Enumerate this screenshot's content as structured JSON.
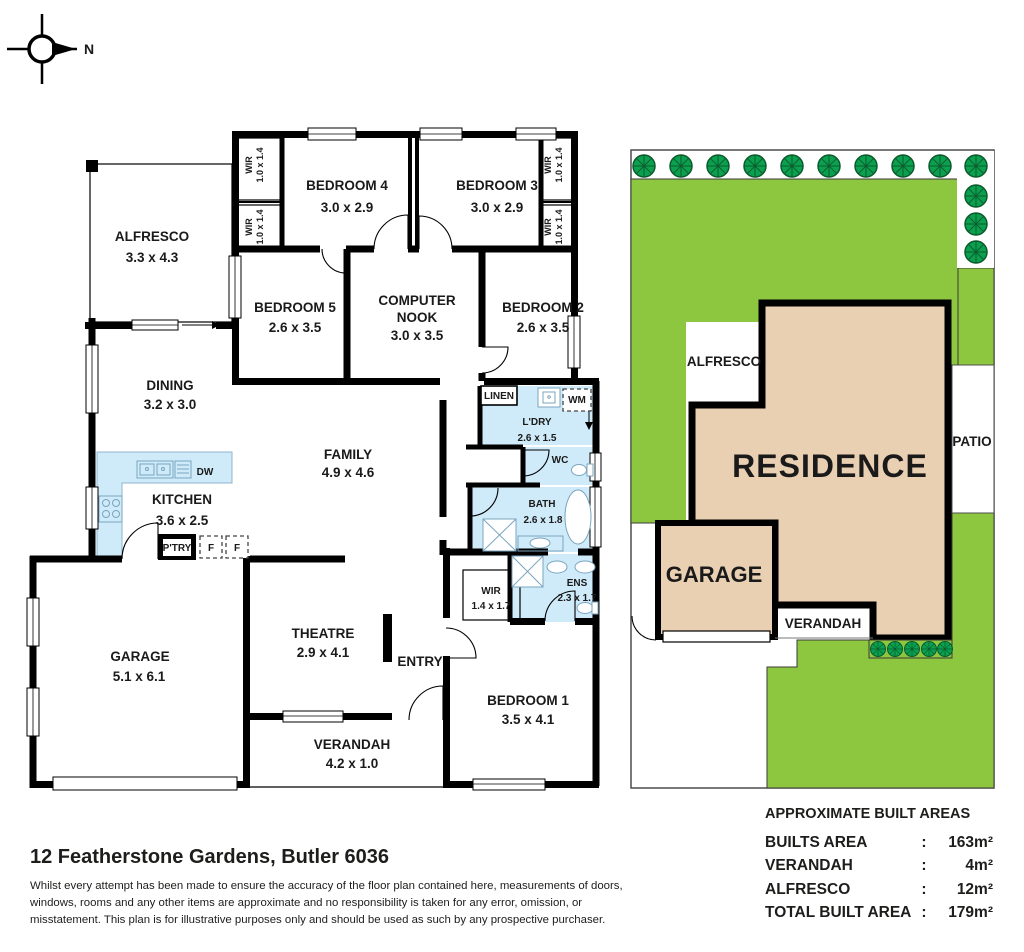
{
  "compass": {
    "north_label": "N"
  },
  "floor_plan": {
    "rooms": {
      "alfresco": {
        "name": "ALFRESCO",
        "dims": "3.3 x 4.3"
      },
      "bedroom4": {
        "name": "BEDROOM 4",
        "dims": "3.0 x 2.9"
      },
      "bedroom3": {
        "name": "BEDROOM 3",
        "dims": "3.0 x 2.9"
      },
      "bedroom5": {
        "name": "BEDROOM 5",
        "dims": "2.6 x 3.5"
      },
      "computer_nook": {
        "name_line1": "COMPUTER",
        "name_line2": "NOOK",
        "dims": "3.0 x 3.5"
      },
      "bedroom2": {
        "name": "BEDROOM 2",
        "dims": "2.6 x 3.5"
      },
      "dining": {
        "name": "DINING",
        "dims": "3.2 x 3.0"
      },
      "family": {
        "name": "FAMILY",
        "dims": "4.9 x 4.6"
      },
      "kitchen": {
        "name": "KITCHEN",
        "dims": "3.6 x 2.5"
      },
      "laundry": {
        "name": "L'DRY",
        "dims": "2.6 x 1.5"
      },
      "wc": {
        "name": "WC"
      },
      "bath": {
        "name": "BATH",
        "dims": "2.6 x 1.8"
      },
      "ens": {
        "name": "ENS",
        "dims": "2.3 x 1.7"
      },
      "wir_main": {
        "name": "WIR",
        "dims": "1.4 x 1.7"
      },
      "garage": {
        "name": "GARAGE",
        "dims": "5.1 x 6.1"
      },
      "theatre": {
        "name": "THEATRE",
        "dims": "2.9 x 4.1"
      },
      "entry": {
        "name": "ENTRY"
      },
      "verandah": {
        "name": "VERANDAH",
        "dims": "4.2 x 1.0"
      },
      "bedroom1": {
        "name": "BEDROOM 1",
        "dims": "3.5 x 4.1"
      }
    },
    "closets": {
      "wir": "WIR",
      "wir_dims": "1.0 x 1.4",
      "linen": "LINEN"
    },
    "fixtures": {
      "wm": "WM",
      "dw": "DW",
      "pantry": "P'TRY",
      "fridge": "F"
    }
  },
  "site_plan": {
    "labels": {
      "residence": "RESIDENCE",
      "garage": "GARAGE",
      "alfresco": "ALFRESCO",
      "verandah": "VERANDAH",
      "patio": "PATIO"
    },
    "colors": {
      "lawn": "#8dc63f",
      "tree_fill": "#0aa04f",
      "tree_outline": "#0c5b2d",
      "residence_fill": "#ead0b2",
      "wet_area_blue": "#cfeaf8"
    }
  },
  "areas": {
    "title": "APPROXIMATE BUILT AREAS",
    "rows": [
      {
        "label": "BUILTS AREA",
        "colon": ":",
        "value": "163m²"
      },
      {
        "label": "VERANDAH",
        "colon": ":",
        "value": "4m²"
      },
      {
        "label": "ALFRESCO",
        "colon": ":",
        "value": "12m²"
      },
      {
        "label": "TOTAL BUILT AREA",
        "colon": ":",
        "value": "179m²"
      }
    ]
  },
  "footer": {
    "address": "12 Featherstone Gardens, Butler 6036",
    "disclaimer": "Whilst every attempt has been made to ensure the accuracy of the floor plan contained here, measurements of doors, windows, rooms and any other items are approximate and no responsibility is taken for any error, omission, or misstatement. This plan is for illustrative purposes only and should be used as such by any prospective purchaser."
  }
}
